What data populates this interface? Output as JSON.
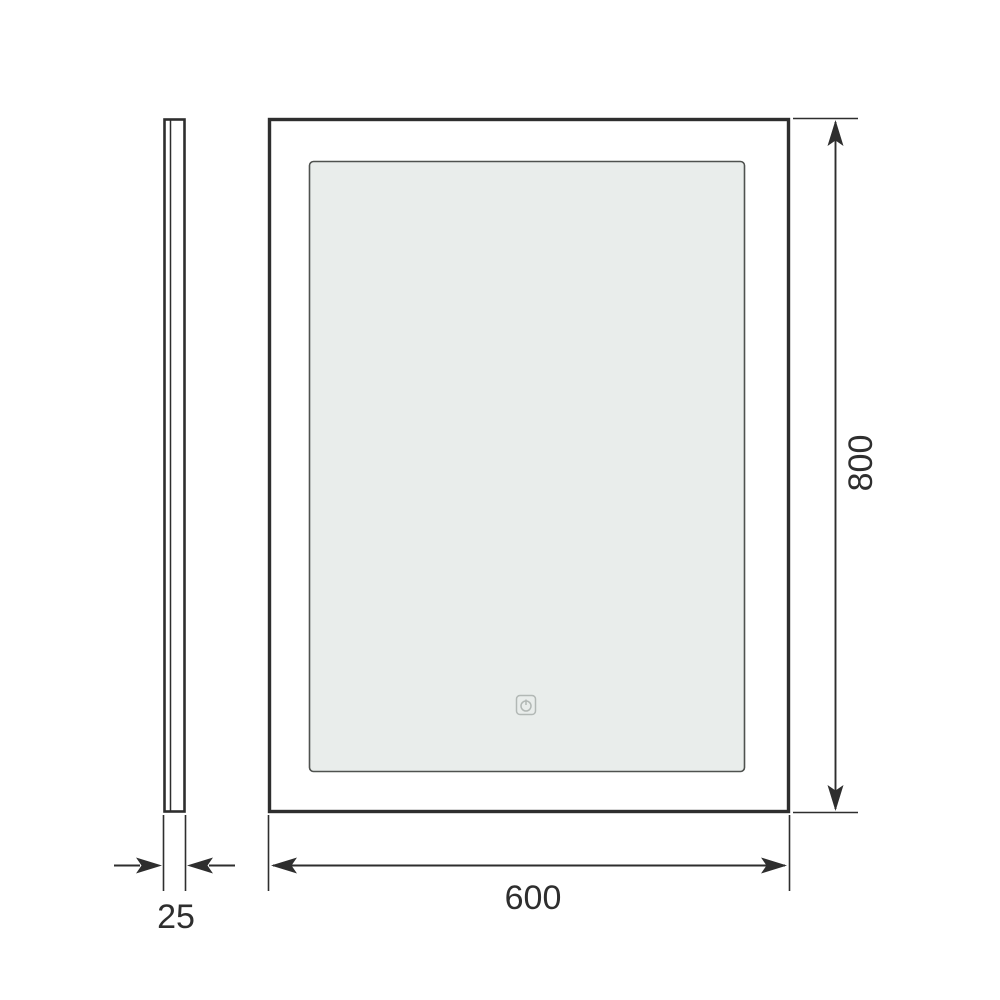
{
  "drawing": {
    "front_view": {
      "width_label": "600",
      "height_label": "800"
    },
    "side_view": {
      "depth_label": "25"
    },
    "icons": {
      "touch_sensor": "power-touch-icon"
    },
    "colors": {
      "line": "#2e2e2e",
      "inner_stroke": "#4f524f",
      "mirror_fill": "#e9edeb",
      "icon": "#b2b8b5",
      "text": "#2e2e2e",
      "background": "#ffffff"
    }
  }
}
